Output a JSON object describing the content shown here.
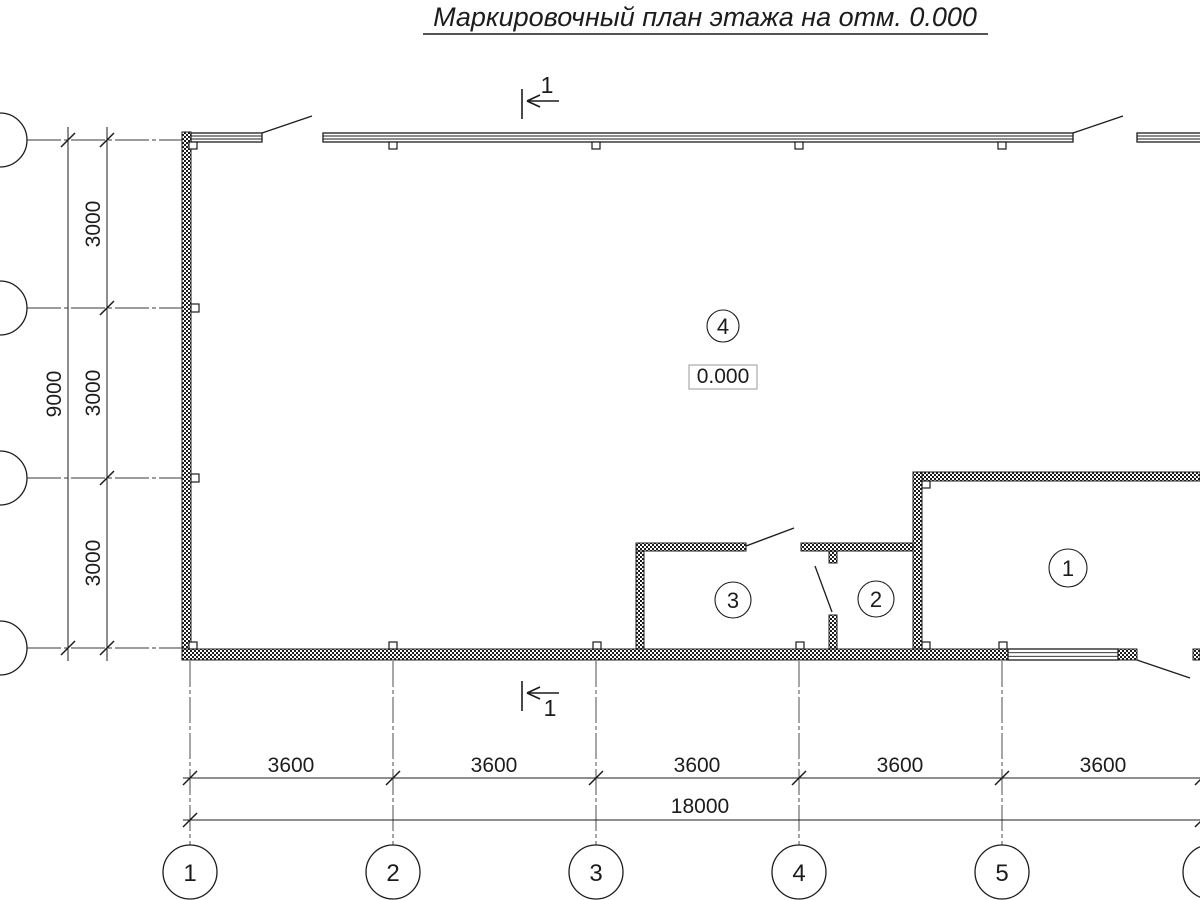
{
  "title": "Маркировочный план этажа на отм. 0.000",
  "elevation_mark": "0.000",
  "section_mark": {
    "top_label": "1",
    "bottom_label": "1"
  },
  "rooms": {
    "room1": "1",
    "room2": "2",
    "room3": "3",
    "room4": "4"
  },
  "axes_bottom": {
    "a1": "1",
    "a2": "2",
    "a3": "3",
    "a4": "4",
    "a5": "5",
    "a6": "6"
  },
  "dims_horizontal": {
    "seg1": "3600",
    "seg2": "3600",
    "seg3": "3600",
    "seg4": "3600",
    "seg5": "3600",
    "total": "18000"
  },
  "dims_vertical": {
    "seg1": "3000",
    "seg2": "3000",
    "seg3": "3000",
    "total": "9000"
  },
  "colors": {
    "ink": "#1c1c1c",
    "background": "#ffffff",
    "elevation_box_border": "#9a9a9a"
  }
}
